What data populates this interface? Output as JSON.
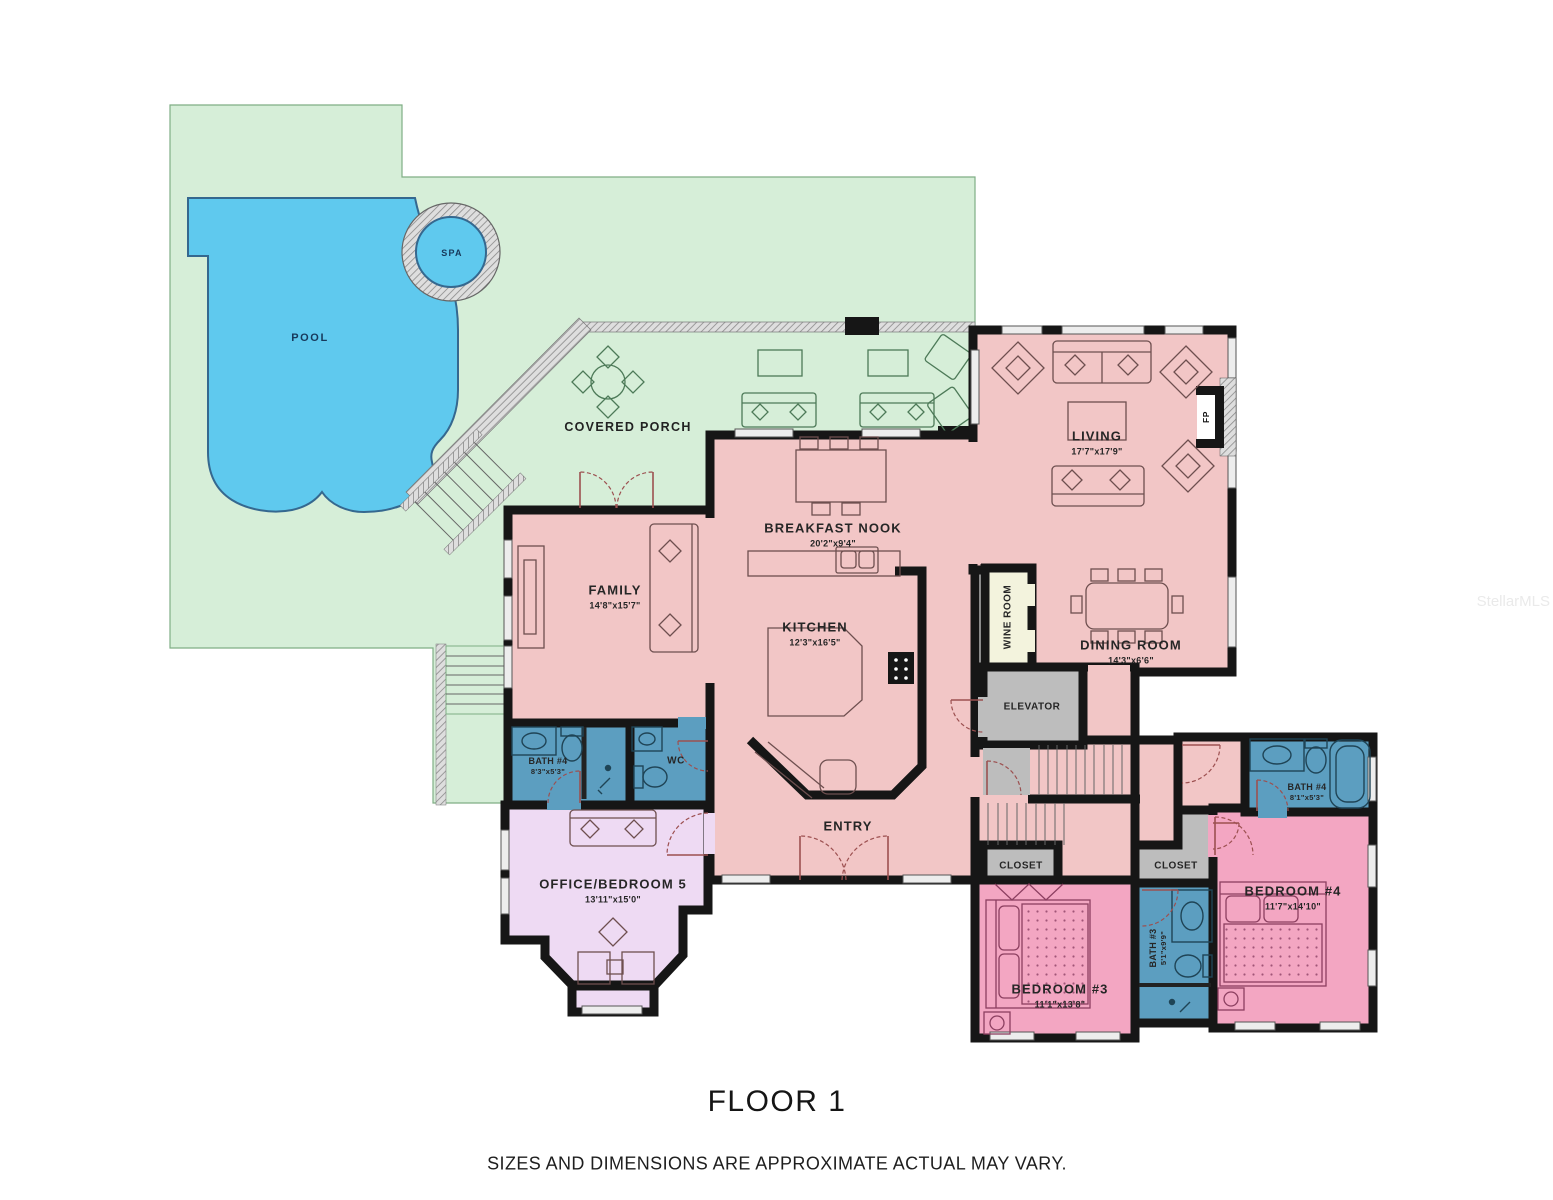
{
  "floorplan": {
    "title": "FLOOR 1",
    "disclaimer": "SIZES AND DIMENSIONS ARE APPROXIMATE ACTUAL MAY VARY.",
    "watermark": "StellarMLS",
    "outdoor": {
      "pool": "POOL",
      "spa": "SPA",
      "porch": "COVERED PORCH"
    },
    "rooms": [
      {
        "name": "LIVING",
        "dims": "17'7\"x17'9\""
      },
      {
        "name": "BREAKFAST NOOK",
        "dims": "20'2\"x9'4\""
      },
      {
        "name": "KITCHEN",
        "dims": "12'3\"x16'5\""
      },
      {
        "name": "FAMILY",
        "dims": "14'8\"x15'7\""
      },
      {
        "name": "DINING ROOM",
        "dims": "14'3\"x6'6\""
      },
      {
        "name": "WINE ROOM"
      },
      {
        "name": "ELEVATOR"
      },
      {
        "name": "BATH #4",
        "dims": "8'3\"x5'3\""
      },
      {
        "name": "WC"
      },
      {
        "name": "OFFICE/BEDROOM 5",
        "dims": "13'11\"x15'0\""
      },
      {
        "name": "ENTRY"
      },
      {
        "name": "CLOSET"
      },
      {
        "name": "CLOSET"
      },
      {
        "name": "BEDROOM #3",
        "dims": "11'1\"x13'8\""
      },
      {
        "name": "BATH #3",
        "dims": "5'1\"x9'9\""
      },
      {
        "name": "BEDROOM #4",
        "dims": "11'7\"x14'10\""
      },
      {
        "name": "BATH #4",
        "dims": "8'1\"x5'3\""
      },
      {
        "name": "FP"
      }
    ],
    "colors": {
      "yard_green": "#d6eed8",
      "pool_blue": "#5fc9ee",
      "interior_pink": "#f2c6c6",
      "bedroom_pink": "#f3a6c2",
      "bath_blue": "#5c9ec0",
      "office_purple": "#eedaf3",
      "utility_gray": "#bdbdbd",
      "wine_cream": "#f3f3dd",
      "wall_black": "#161616"
    }
  }
}
